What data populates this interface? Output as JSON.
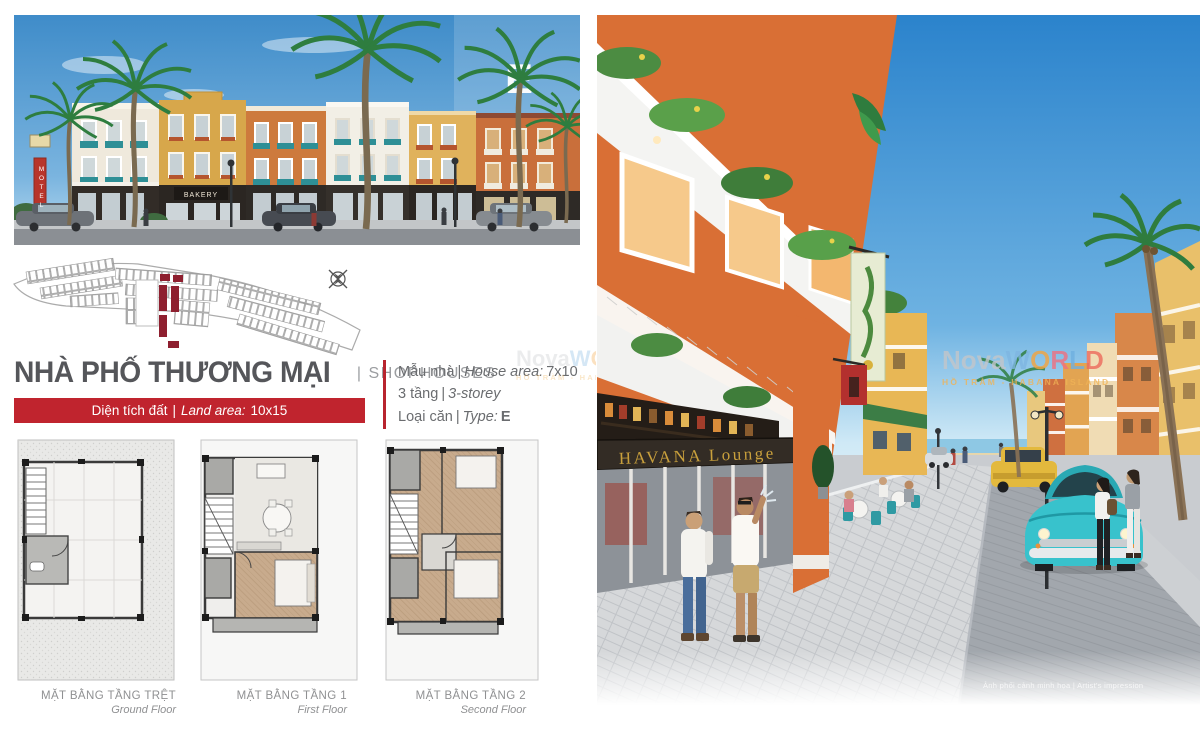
{
  "header": {
    "title_vi": "NHÀ PHỐ THƯƠNG MẠI",
    "title_en": "| SHOPHOUSES"
  },
  "text": {
    "sep": "|"
  },
  "banner": {
    "vi": "Diện tích đất",
    "en": "Land area:",
    "value": "10x15"
  },
  "specs": [
    {
      "vi": "Mẫu nhà",
      "en": "House area:",
      "value": "7x10"
    },
    {
      "vi": "3 tầng",
      "en": "3-storey",
      "value": ""
    },
    {
      "vi": "Loại căn",
      "en": "Type:",
      "value": "E"
    }
  ],
  "plans": [
    {
      "vi": "MẶT BẰNG TẦNG TRỆT",
      "en": "Ground Floor"
    },
    {
      "vi": "MẶT BẰNG TẦNG 1",
      "en": "First Floor"
    },
    {
      "vi": "MẶT BẰNG TẦNG 2",
      "en": "Second Floor"
    }
  ],
  "elevation": {
    "type_badge": "E",
    "motel_sign": "MOTEL",
    "bakery_sign": "BAKERY"
  },
  "street_scene": {
    "lounge_sign": "HAVANA Lounge",
    "caption": "Ảnh phối cảnh minh họa | Artist's impression"
  },
  "watermark": {
    "prefix": "Nova",
    "letters": [
      "W",
      "O",
      "R",
      "L",
      "D"
    ],
    "location": "HỒ TRÀM - HABANA ISLAND"
  },
  "colors": {
    "accent_red": "#c0242e",
    "maroon_lot": "#8e1f2f",
    "teal": "#2e8f96",
    "car_teal": "#38c2cc",
    "sky": "#2e86cf"
  }
}
